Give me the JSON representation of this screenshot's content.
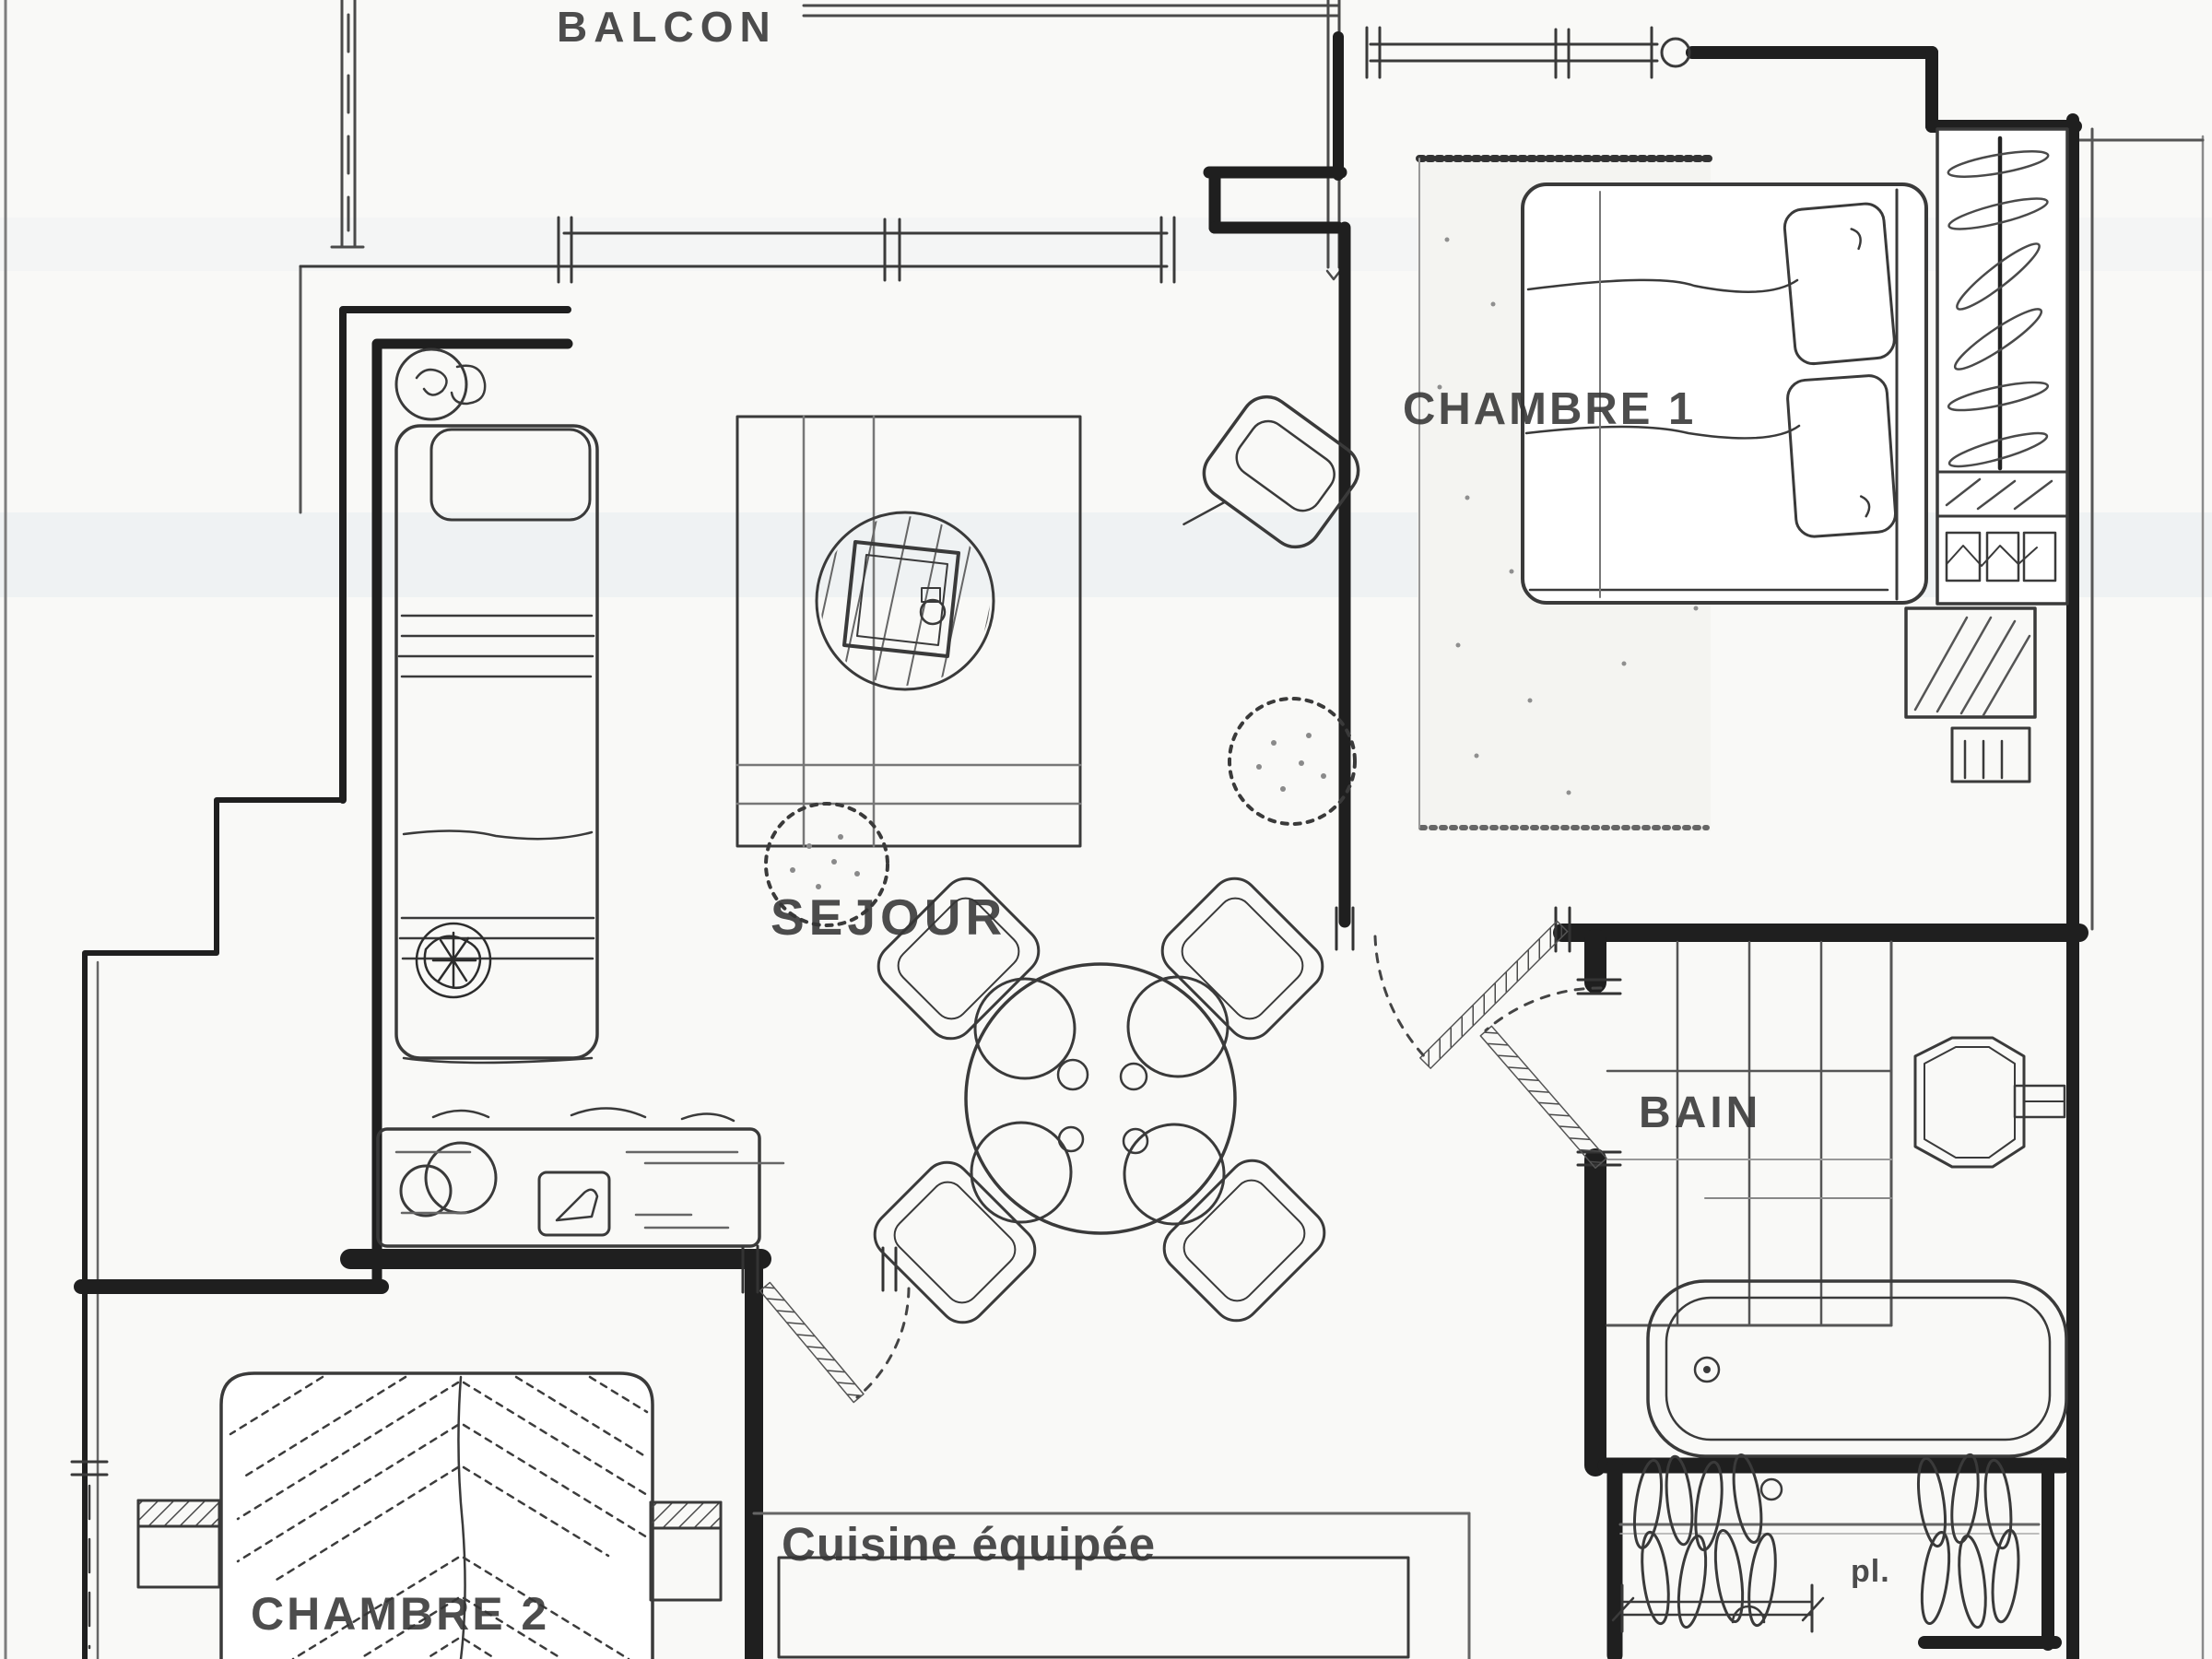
{
  "document": {
    "type": "apartment floor plan (scanned sketch)",
    "language": "fr"
  },
  "rooms": {
    "balcon": {
      "label": "BALCON"
    },
    "sejour": {
      "label": "SEJOUR"
    },
    "chambre1": {
      "label": "CHAMBRE 1"
    },
    "chambre2": {
      "label": "CHAMBRE 2"
    },
    "bain": {
      "label": "BAIN"
    },
    "cuisine": {
      "label": "Cuisine équipée"
    },
    "placard": {
      "label": "pl."
    }
  },
  "colors": {
    "paper": "#f9f9f7",
    "ink": "#2e2e2e",
    "wall": "#1f1f1f",
    "light_line": "#777777",
    "scan_tint": "#cdd9e8"
  }
}
